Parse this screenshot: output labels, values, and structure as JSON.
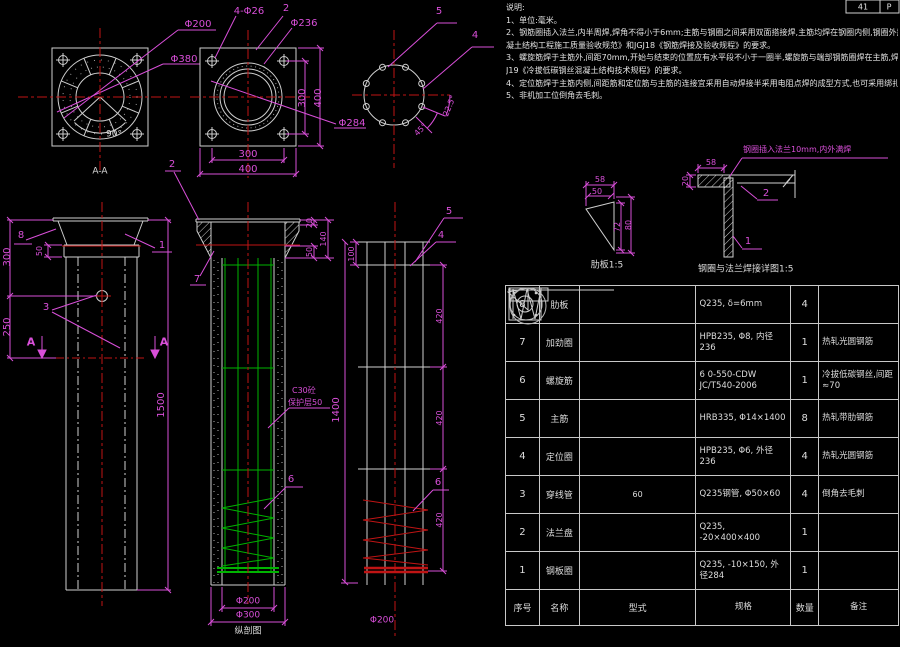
{
  "app": {
    "background": "#000000",
    "line_color": "#cfcfcf",
    "dim_color": "#d94fd9",
    "center_color": "#c01414",
    "rebar_color": "#00b300"
  },
  "title_block": {
    "cell1": "41",
    "cell2": "P"
  },
  "notes": {
    "title": "说明:",
    "lines": [
      "1、单位:毫米。",
      "2、钢筋圈插入法兰,内半周焊,焊角不得小于6mm;主筋与钢圈之间采用双面搭接焊,主筋均焊在钢圈内侧,钢圈外露部分应适当加以保护,焊接质量应符合GB50204《混",
      "凝土结构工程施工质量验收规范》和JGJ18《钢筋焊接及验收规程》的要求。",
      "3、螺旋筋焊于主筋外,间距70mm,开始与结束的位置应有水平段不小于一圈半,螺旋筋与端部钢筋圈焊在主筋,焊缝长30mm,角度为135°,其生产加工应符合JG",
      "J19《冷拔低碳钢丝混凝土结构技术规程》的要求。",
      "4、定位筋焊于主筋内侧,间距筋和定位筋与主筋的连接宜采用自动焊接半采用电阻点焊的成型方式,也可采用绑扎成型。",
      "5、非机加工位倒角去毛刺。"
    ]
  },
  "views": {
    "aa": {
      "caption": "A-A",
      "d200": "Φ200",
      "d380": "Φ380",
      "a90": "90°"
    },
    "flange": {
      "bolts": "4-Φ26",
      "item2": "2",
      "d236": "Φ236",
      "d284": "Φ284",
      "dim300v": "300",
      "dim400v": "400",
      "dim300h": "300",
      "dim400h": "400"
    },
    "ring": {
      "item5": "5",
      "item4": "4",
      "a225": "22.5°",
      "a45": "45°"
    },
    "rib": {
      "caption": "肋板1:5",
      "d58": "58",
      "d50": "50",
      "d72": "72",
      "d80": "80"
    },
    "weld": {
      "caption": "钢圈与法兰焊接详图1:5",
      "note": "钢圈插入法兰10mm,内外满焊",
      "d58": "58",
      "d20": "20",
      "item2": "2",
      "item1": "1"
    },
    "side": {
      "item8": "8",
      "item1": "1",
      "item3": "3",
      "d50": "50",
      "d300": "300",
      "d250": "250",
      "d1500": "1500",
      "marker": "A"
    },
    "longsec": {
      "caption": "纵剖图",
      "item2": "2",
      "item7": "7",
      "item6": "6",
      "d20": "20",
      "d140": "140",
      "d50": "50",
      "concrete": "C30砼",
      "cover": "保护层50",
      "d200": "Φ200",
      "d300": "Φ300"
    },
    "cage": {
      "item5": "5",
      "item4": "4",
      "item6": "6",
      "d100": "100",
      "d1400": "1400",
      "d420": "420",
      "d200": "Φ200"
    }
  },
  "bom": {
    "columns": [
      "序号",
      "名称",
      "型式",
      "规格",
      "数量",
      "备注"
    ],
    "rows": [
      {
        "no": "8",
        "name": "肋板",
        "shape": "triangle",
        "spec": "Q235, δ=6mm",
        "qty": "4",
        "remark": ""
      },
      {
        "no": "7",
        "name": "加劲圈",
        "shape": "circle",
        "spec": "HPB235, Φ8, 内径236",
        "qty": "1",
        "remark": "热轧光圆钢筋"
      },
      {
        "no": "6",
        "name": "螺旋筋",
        "shape": "spring",
        "spec": "6 0-550-CDW JC/T540-2006",
        "qty": "1",
        "remark": "冷拔低碳钢丝,间距≈70"
      },
      {
        "no": "5",
        "name": "主筋",
        "shape": "line",
        "spec": "HRB335, Φ14×1400",
        "qty": "8",
        "remark": "热轧带肋钢筋"
      },
      {
        "no": "4",
        "name": "定位圈",
        "shape": "circle",
        "spec": "HPB235, Φ6, 外径236",
        "qty": "4",
        "remark": "热轧光圆钢筋"
      },
      {
        "no": "3",
        "name": "穿线管",
        "shape": "tube",
        "spec": "Q235钢管, Φ50×60",
        "qty": "4",
        "remark": "倒角去毛刺",
        "shape_dim": "60"
      },
      {
        "no": "2",
        "name": "法兰盘",
        "shape": "flange",
        "spec": "Q235, -20×400×400",
        "qty": "1",
        "remark": ""
      },
      {
        "no": "1",
        "name": "钢板圈",
        "shape": "circle",
        "spec": "Q235, -10×150, 外径284",
        "qty": "1",
        "remark": ""
      }
    ]
  }
}
